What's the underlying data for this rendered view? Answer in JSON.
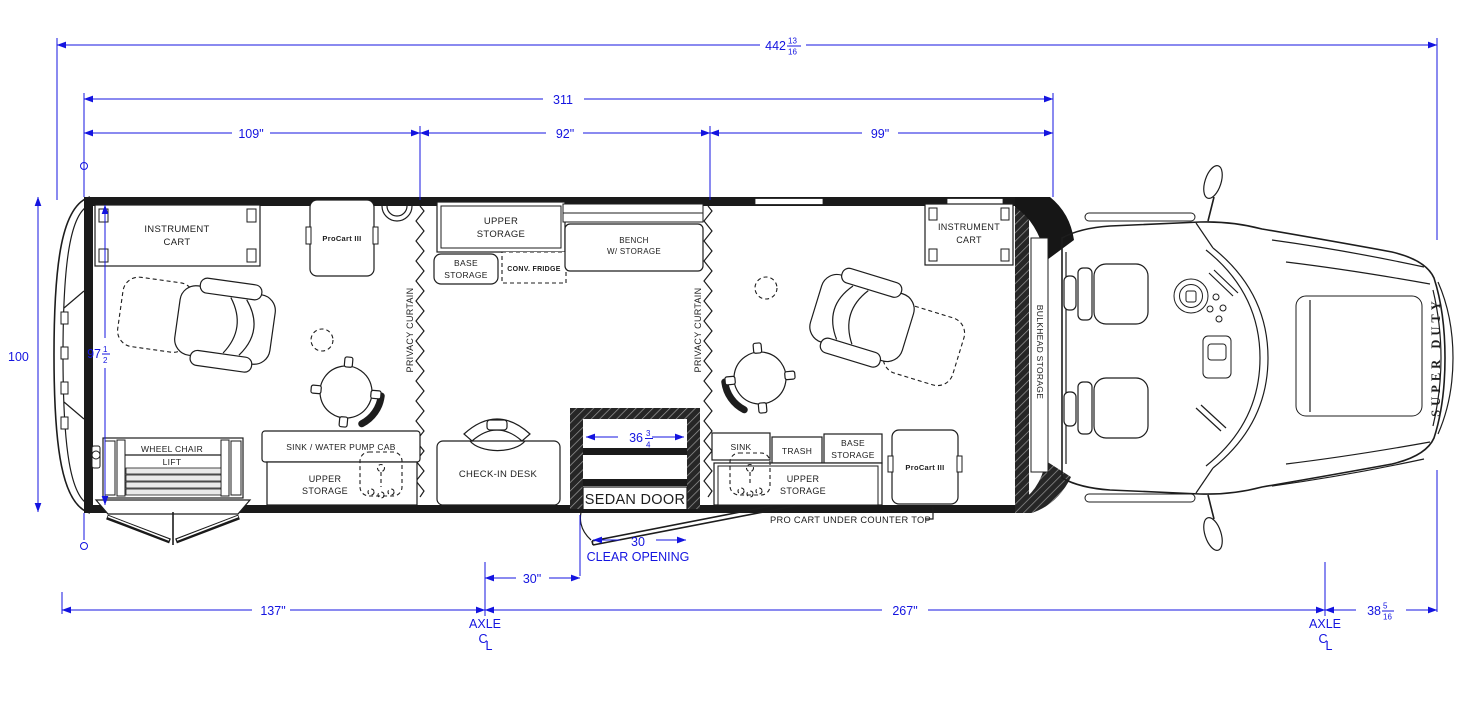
{
  "meta": {
    "drawing_type": "specialty vehicle floor plan (top view)",
    "colors": {
      "dimension_blue": "#1414e0",
      "line_black": "#1d1d1d",
      "background": "#ffffff"
    }
  },
  "dimensions": {
    "overall_length": {
      "whole": "442",
      "num": "13",
      "den": "16"
    },
    "box_length": "311",
    "bay_rear": "109\"",
    "bay_mid": "92\"",
    "bay_front": "99\"",
    "overall_width": "100",
    "interior_width": {
      "whole": "97",
      "num": "1",
      "den": "2"
    },
    "sedan_door_width": {
      "whole": "36",
      "num": "3",
      "den": "4"
    },
    "clear_opening_value": "30",
    "clear_opening_label": "CLEAR OPENING",
    "door_to_axle": "30\"",
    "rear_overhang": "137\"",
    "wheelbase": "267\"",
    "front_overhang": {
      "whole": "38",
      "num": "5",
      "den": "16"
    },
    "axle_left": {
      "label": "AXLE",
      "c": "C",
      "l": "L"
    },
    "axle_right": {
      "label": "AXLE",
      "c": "C",
      "l": "L"
    }
  },
  "labels": {
    "instrument_cart_rear": {
      "line1": "INSTRUMENT",
      "line2": "CART"
    },
    "procart_rear": "ProCart III",
    "privacy_curtain_left": "PRIVACY CURTAIN",
    "privacy_curtain_right": "PRIVACY CURTAIN",
    "upper_storage_galley": {
      "line1": "UPPER",
      "line2": "STORAGE"
    },
    "base_storage_galley": {
      "line1": "BASE",
      "line2": "STORAGE"
    },
    "conv_fridge": "CONV. FRIDGE",
    "bench": {
      "line1": "BENCH",
      "line2": "W/ STORAGE"
    },
    "instrument_cart_front": {
      "line1": "INSTRUMENT",
      "line2": "CART"
    },
    "bulkhead_storage": "BULKHEAD STORAGE",
    "wheelchair_lift": {
      "line1": "WHEEL CHAIR",
      "line2": "LIFT"
    },
    "sink_water_pump": "SINK / WATER PUMP CAB",
    "upper_storage_rear": {
      "line1": "UPPER",
      "line2": "STORAGE"
    },
    "checkin_desk": "CHECK-IN DESK",
    "sedan_door": "SEDAN DOOR",
    "sink": "SINK",
    "trash": "TRASH",
    "base_storage_front": {
      "line1": "BASE",
      "line2": "STORAGE"
    },
    "upper_storage_front": {
      "line1": "UPPER",
      "line2": "STORAGE"
    },
    "procart_front": "ProCart III",
    "procart_note": "PRO CART UNDER COUNTER TOP",
    "truck_badge": "SUPER DUTY"
  }
}
